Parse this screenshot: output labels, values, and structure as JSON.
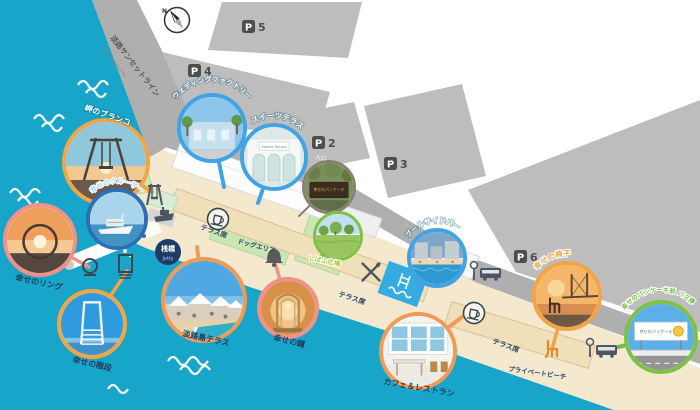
{
  "compass": {
    "north": "N"
  },
  "road": {
    "name_jp": "淡路サンセットライン",
    "name_en": "Awaji Sunset Line"
  },
  "parking": {
    "letter": "P",
    "lots": {
      "p2": "2",
      "p3": "3",
      "p4": "4",
      "p5": "5",
      "p6": "6"
    },
    "p2_note": "入口"
  },
  "jetty": {
    "jp": "桟橋",
    "en": "Jetty"
  },
  "area_labels": {
    "terrace_seats_1": "テラス席",
    "terrace_seats_2": "テラス席",
    "terrace_seats_3": "テラス席",
    "dog_area": "ドッグエリア",
    "private_beach": "プライベートビーチ"
  },
  "spots": {
    "swing": {
      "label": "岬のブランコ"
    },
    "wedding_factory": {
      "label": "ウェディングファクトリー"
    },
    "sweets_terrace": {
      "label": "スイーツテラス",
      "photo_sign": "Sweets Terrace"
    },
    "pancake_sign": {
      "photo_sign": "幸せのパンケーキ"
    },
    "cruiser": {
      "label": "幸せのクルーザー"
    },
    "ring": {
      "label": "幸せのリング"
    },
    "stairs": {
      "label": "幸せの階段"
    },
    "awaji_terrace": {
      "label": "淡路島テラス"
    },
    "bell": {
      "label": "幸せの鐘"
    },
    "cafe": {
      "label": "カフェ＆レストラン"
    },
    "poolside_bar": {
      "label": "プールサイドバー"
    },
    "lawn_plaza": {
      "label": "しばふ広場"
    },
    "chair": {
      "label": "幸せの椅子"
    },
    "bus_stop": {
      "label": "幸せのパンケーキ前 バス停",
      "photo_sign": "幸せのパンケーキ"
    }
  },
  "icons": {
    "compass": "compass-rose",
    "parking": "P-square",
    "bus_stop": "pole+bus",
    "bell": "bell",
    "restaurant": "fork-knife-cross",
    "terrace_cafe": "cup-in-circle",
    "pool": "pool-ladder-waves",
    "swing": "swing-frame",
    "ferry": "ship",
    "ring": "ring-on-stand",
    "stairs": "gate-steps",
    "chair": "chair-side"
  },
  "colors": {
    "sea": "#17A6C9",
    "sand": "#F4E9CE",
    "road": "#AFAFAF",
    "parking_block": "#BDBDBD",
    "lawn": "#CBE5B5",
    "pool": "#35ACDF",
    "border_orange": "#F2A544",
    "border_blue": "#3FA3E4",
    "border_navy": "#2C6FB5",
    "border_salmon": "#F0928A",
    "border_green": "#7DC243",
    "label_navy": "#1F3C5F"
  }
}
